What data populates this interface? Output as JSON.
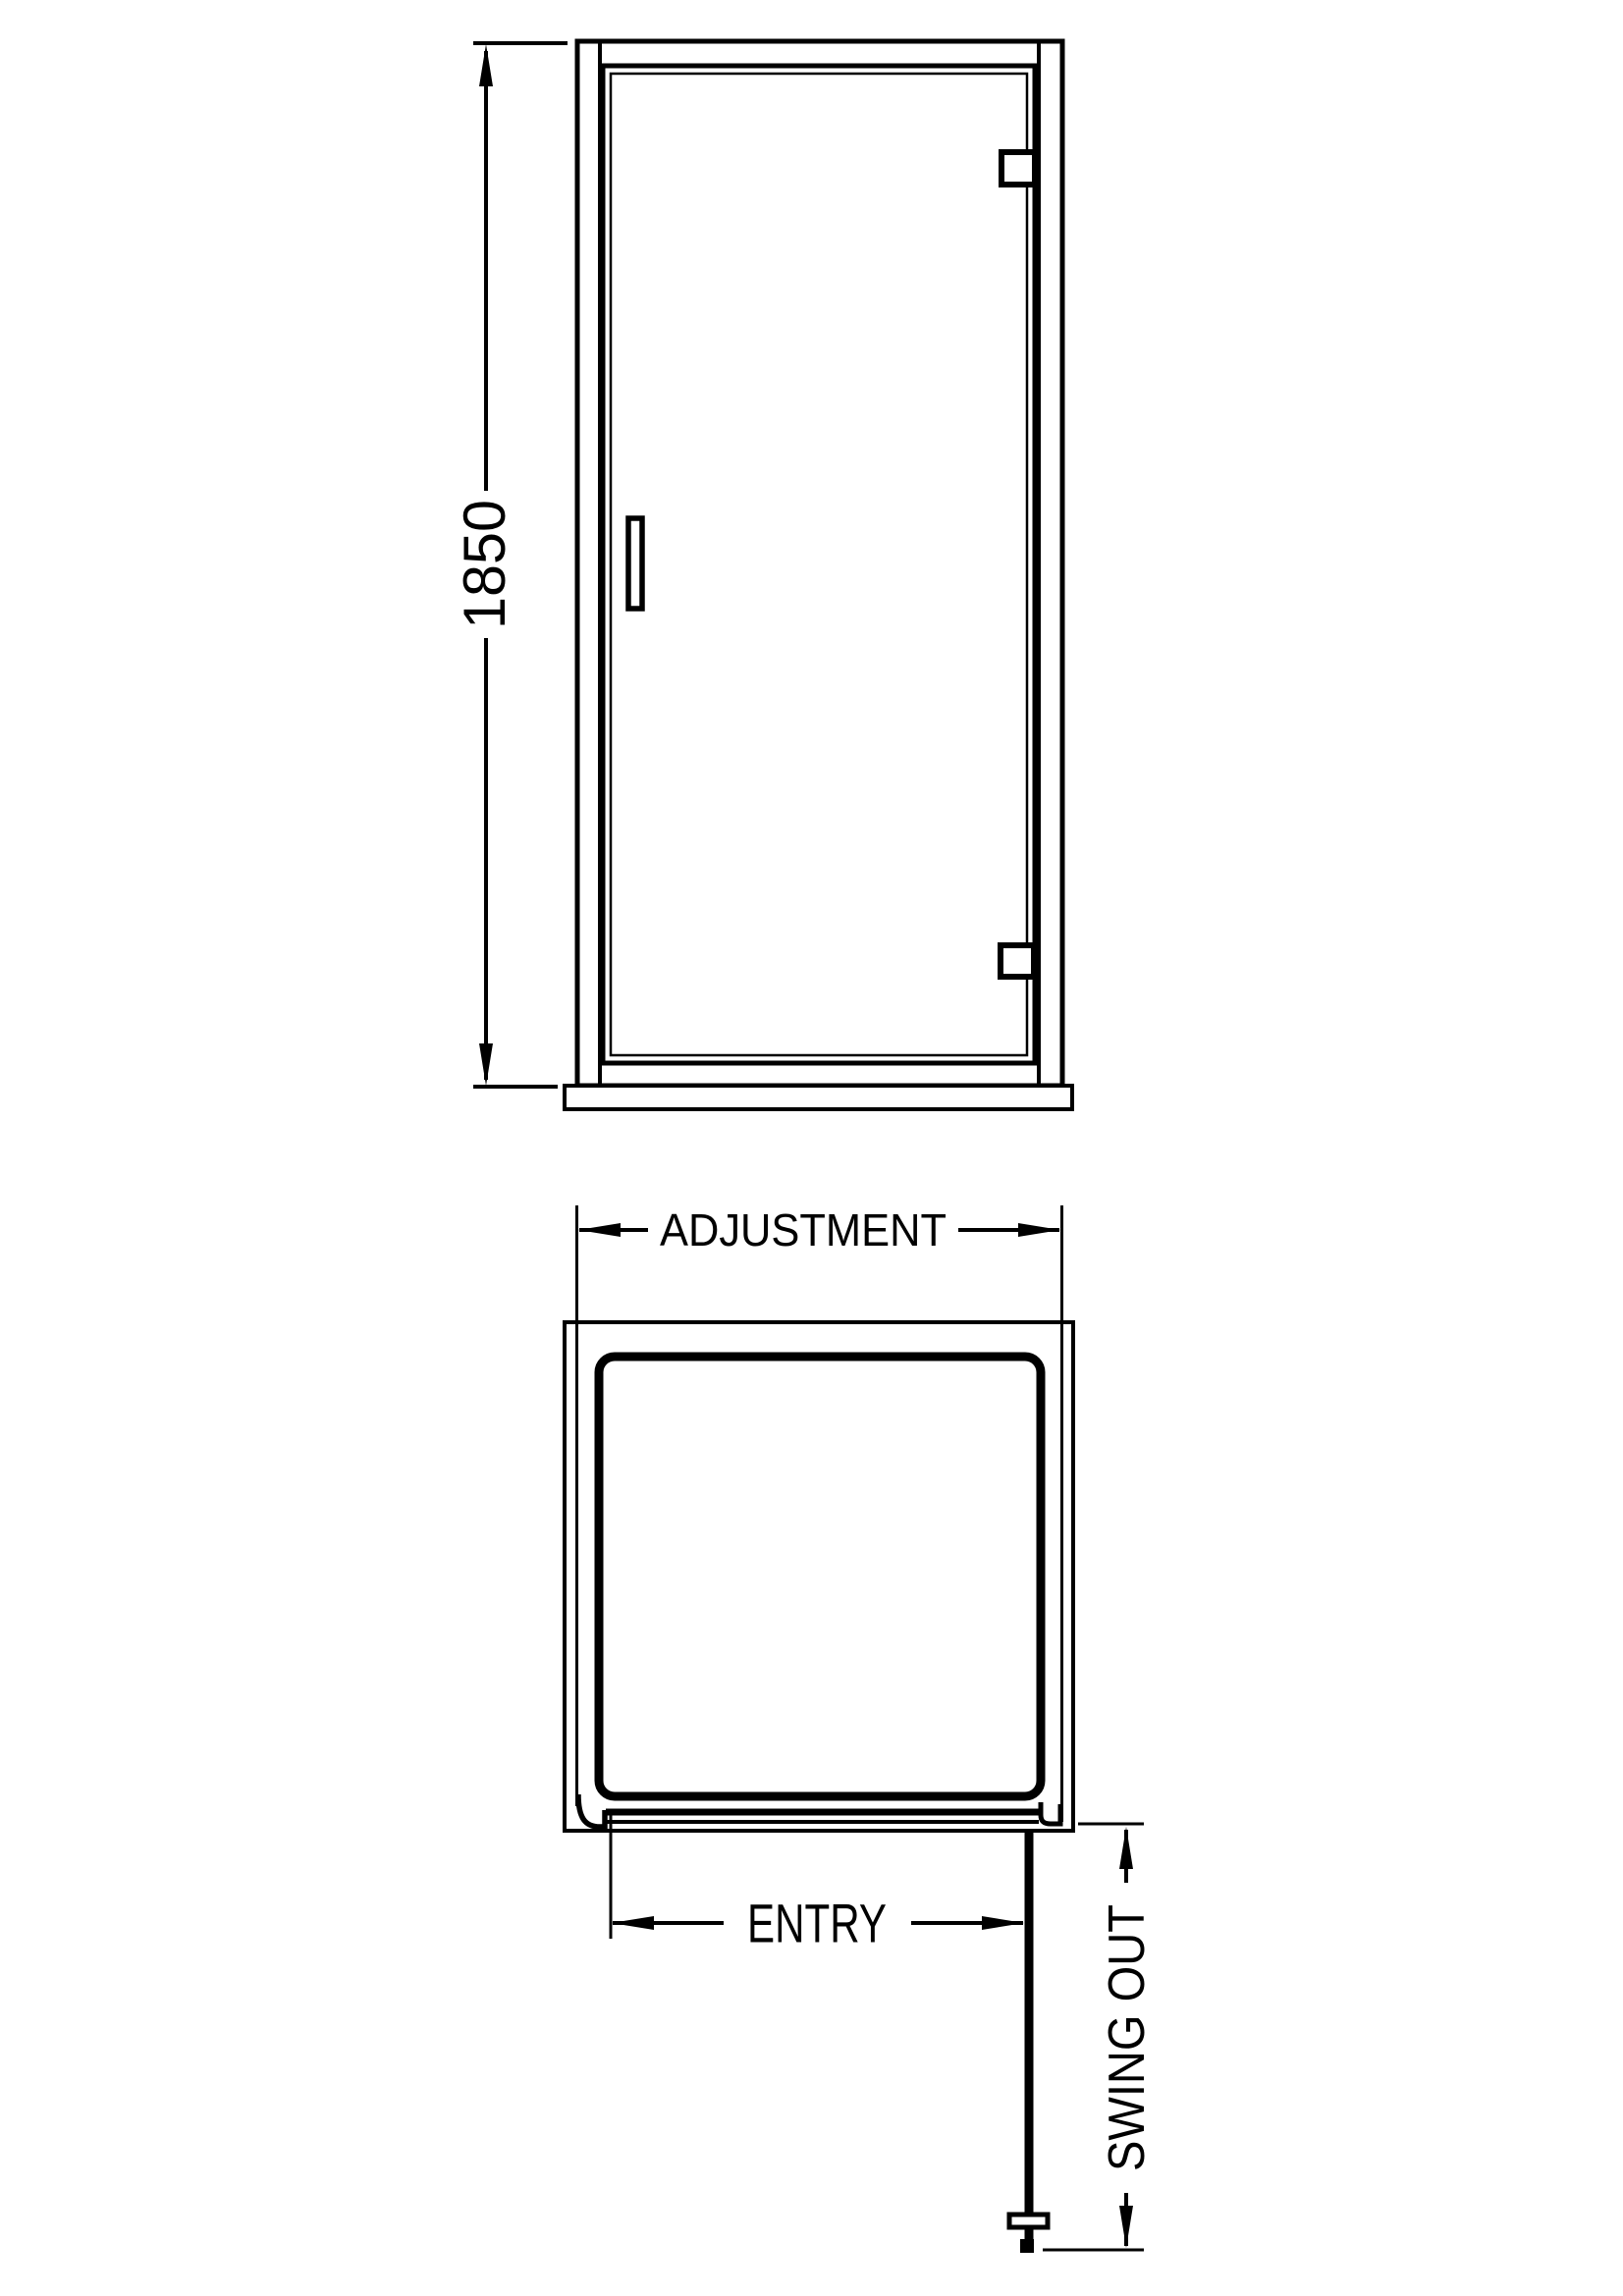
{
  "colors": {
    "background": "#ffffff",
    "line": "#000000"
  },
  "drawing": {
    "type": "technical-dimension-diagram",
    "subject": "hinged shower door, front elevation and plan view"
  },
  "labels": {
    "height": "1850",
    "adjustment": "ADJUSTMENT",
    "entry": "ENTRY",
    "swing_out": "SWING OUT"
  }
}
